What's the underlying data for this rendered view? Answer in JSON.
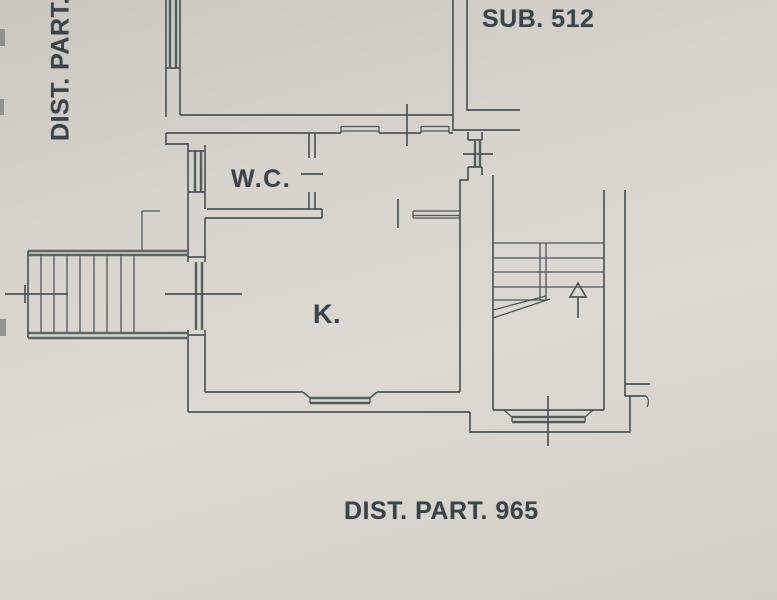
{
  "labels": {
    "left_district": "DIST. PART.",
    "sub_unit": "SUB. 512",
    "wc_room": "W.C.",
    "kitchen_room": "K.",
    "bottom_district": "DIST. PART. 965"
  },
  "colors": {
    "paper": "#d6d3cc",
    "ink": "#4d555a",
    "text": "#3c444b"
  }
}
